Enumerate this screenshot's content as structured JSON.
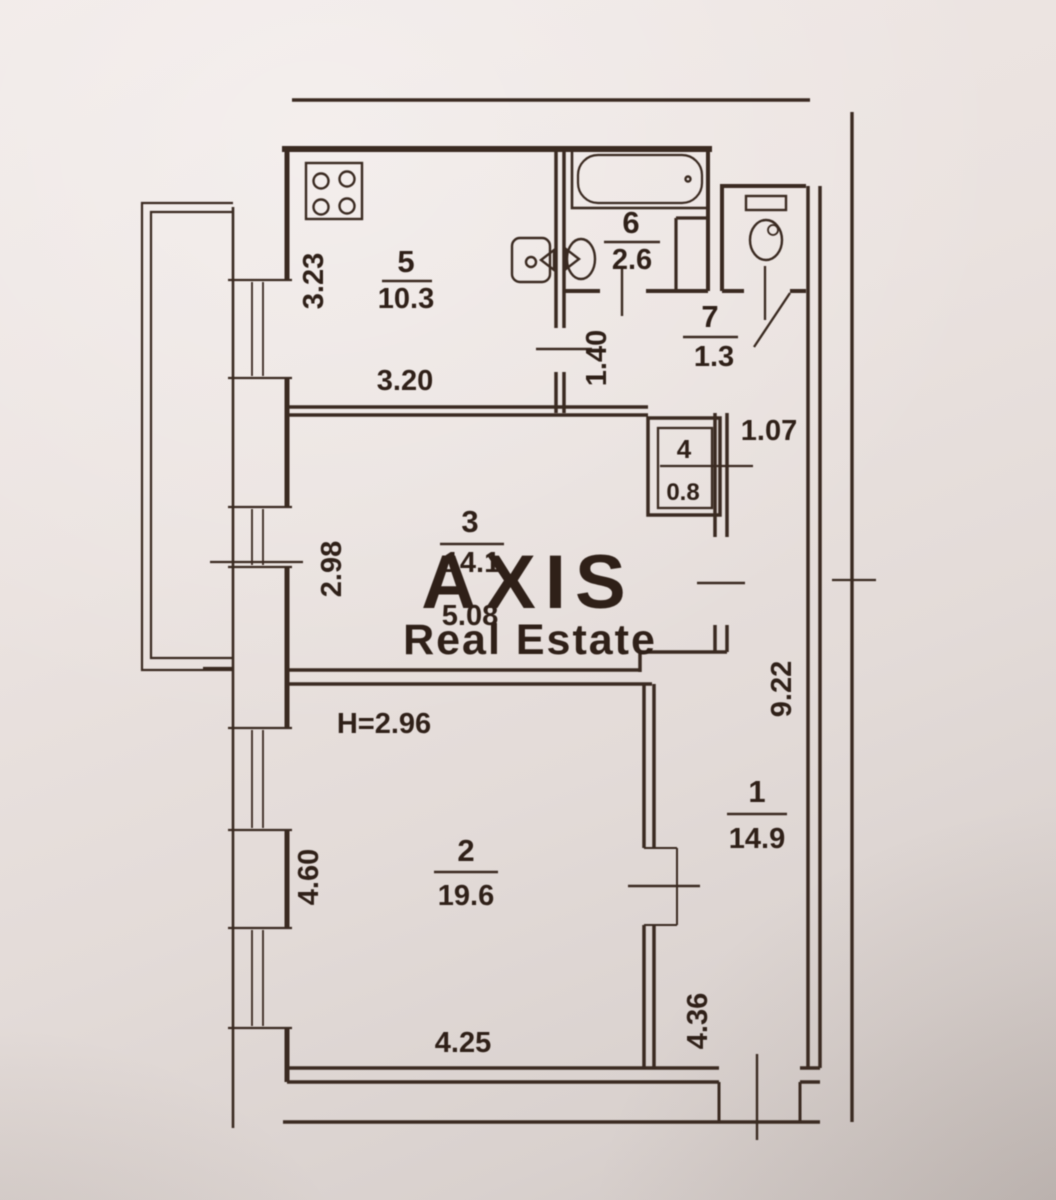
{
  "watermark": {
    "brand": "AXIS",
    "tagline": "Real Estate"
  },
  "plan": {
    "ceiling_height": "H=2.96",
    "rooms": [
      {
        "num": "1",
        "area": "14.9"
      },
      {
        "num": "2",
        "area": "19.6"
      },
      {
        "num": "3",
        "area": "14.1"
      },
      {
        "num": "4",
        "area": "0.8"
      },
      {
        "num": "5",
        "area": "10.3"
      },
      {
        "num": "6",
        "area": "2.6"
      },
      {
        "num": "7",
        "area": "1.3"
      }
    ],
    "dimensions": {
      "kitchen_depth": "3.23",
      "kitchen_width": "3.20",
      "hall_height": "1.40",
      "corridor_width": "1.07",
      "room3_depth": "2.98",
      "room3_span": "5.08",
      "corridor_length": "9.22",
      "room2_depth": "4.60",
      "room2_width": "4.25",
      "entry_length": "4.36"
    }
  },
  "colors": {
    "paper": "#eae2df",
    "ink": "#3a2a21",
    "watermark": "#ffffff"
  }
}
